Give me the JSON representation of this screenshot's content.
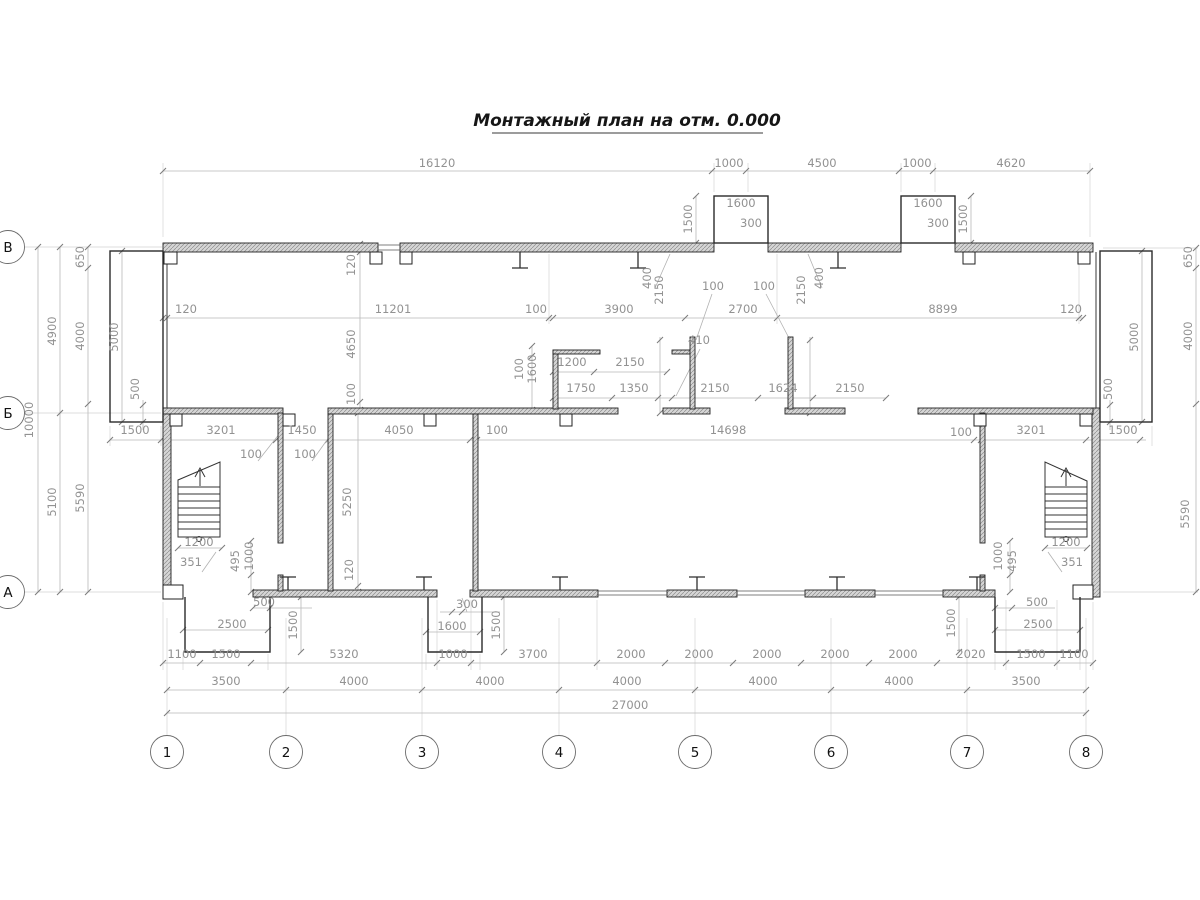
{
  "title": {
    "text": "Монтажный план на отм. 0.000"
  },
  "plan": {
    "colors": {
      "wall_hatch": "#d6d6d6",
      "wall_edge": "#222222",
      "dim_line": "#b9b9b9",
      "dim_text": "#929292",
      "axis_text": "#111111"
    },
    "axis_columns": {
      "y": 752,
      "items": [
        {
          "label": "1",
          "x": 167
        },
        {
          "label": "2",
          "x": 286
        },
        {
          "label": "3",
          "x": 422
        },
        {
          "label": "4",
          "x": 559
        },
        {
          "label": "5",
          "x": 695
        },
        {
          "label": "6",
          "x": 831
        },
        {
          "label": "7",
          "x": 967
        },
        {
          "label": "8",
          "x": 1086
        }
      ]
    },
    "axis_rows": {
      "x": 8,
      "items": [
        {
          "label": "В",
          "y": 247
        },
        {
          "label": "Б",
          "y": 413
        },
        {
          "label": "А",
          "y": 592
        }
      ]
    },
    "dimensions": [
      {
        "t": "16120",
        "x": 437,
        "y": 167,
        "r": 0
      },
      {
        "t": "1000",
        "x": 729,
        "y": 167,
        "r": 0
      },
      {
        "t": "4500",
        "x": 822,
        "y": 167,
        "r": 0
      },
      {
        "t": "1000",
        "x": 917,
        "y": 167,
        "r": 0
      },
      {
        "t": "4620",
        "x": 1011,
        "y": 167,
        "r": 0
      },
      {
        "t": "1600",
        "x": 741,
        "y": 207,
        "r": 0
      },
      {
        "t": "300",
        "x": 751,
        "y": 227,
        "r": 0
      },
      {
        "t": "1600",
        "x": 928,
        "y": 207,
        "r": 0
      },
      {
        "t": "300",
        "x": 938,
        "y": 227,
        "r": 0
      },
      {
        "t": "1500",
        "x": 692,
        "y": 219,
        "r": 1
      },
      {
        "t": "1500",
        "x": 967,
        "y": 219,
        "r": 1
      },
      {
        "t": "400",
        "x": 651,
        "y": 278,
        "r": 1
      },
      {
        "t": "400",
        "x": 823,
        "y": 278,
        "r": 1
      },
      {
        "t": "2150",
        "x": 663,
        "y": 290,
        "r": 1
      },
      {
        "t": "2150",
        "x": 805,
        "y": 290,
        "r": 1
      },
      {
        "t": "100",
        "x": 713,
        "y": 290,
        "r": 0
      },
      {
        "t": "100",
        "x": 764,
        "y": 290,
        "r": 0
      },
      {
        "t": "120",
        "x": 186,
        "y": 313,
        "r": 0
      },
      {
        "t": "11201",
        "x": 393,
        "y": 313,
        "r": 0
      },
      {
        "t": "100",
        "x": 536,
        "y": 313,
        "r": 0
      },
      {
        "t": "3900",
        "x": 619,
        "y": 313,
        "r": 0
      },
      {
        "t": "2700",
        "x": 743,
        "y": 313,
        "r": 0
      },
      {
        "t": "8899",
        "x": 943,
        "y": 313,
        "r": 0
      },
      {
        "t": "120",
        "x": 1071,
        "y": 313,
        "r": 0
      },
      {
        "t": "120",
        "x": 355,
        "y": 265,
        "r": 1
      },
      {
        "t": "4650",
        "x": 355,
        "y": 344,
        "r": 1
      },
      {
        "t": "100",
        "x": 355,
        "y": 394,
        "r": 1
      },
      {
        "t": "100",
        "x": 523,
        "y": 369,
        "r": 1
      },
      {
        "t": "1600",
        "x": 536,
        "y": 369,
        "r": 1
      },
      {
        "t": "1200",
        "x": 572,
        "y": 366,
        "r": 0
      },
      {
        "t": "2150",
        "x": 630,
        "y": 366,
        "r": 0
      },
      {
        "t": "410",
        "x": 699,
        "y": 344,
        "r": 0
      },
      {
        "t": "1750",
        "x": 581,
        "y": 392,
        "r": 0
      },
      {
        "t": "1350",
        "x": 634,
        "y": 392,
        "r": 0
      },
      {
        "t": "2150",
        "x": 715,
        "y": 392,
        "r": 0
      },
      {
        "t": "1624",
        "x": 783,
        "y": 392,
        "r": 0
      },
      {
        "t": "2150",
        "x": 850,
        "y": 392,
        "r": 0
      },
      {
        "t": "10000",
        "x": 33,
        "y": 420,
        "r": 1
      },
      {
        "t": "4900",
        "x": 56,
        "y": 331,
        "r": 1
      },
      {
        "t": "5100",
        "x": 56,
        "y": 502,
        "r": 1
      },
      {
        "t": "650",
        "x": 84,
        "y": 257,
        "r": 1
      },
      {
        "t": "4000",
        "x": 84,
        "y": 336,
        "r": 1
      },
      {
        "t": "5590",
        "x": 84,
        "y": 498,
        "r": 1
      },
      {
        "t": "5000",
        "x": 118,
        "y": 337,
        "r": 1
      },
      {
        "t": "500",
        "x": 139,
        "y": 389,
        "r": 1
      },
      {
        "t": "650",
        "x": 1192,
        "y": 257,
        "r": 1
      },
      {
        "t": "4000",
        "x": 1192,
        "y": 336,
        "r": 1
      },
      {
        "t": "5590",
        "x": 1189,
        "y": 514,
        "r": 1
      },
      {
        "t": "5000",
        "x": 1138,
        "y": 337,
        "r": 1
      },
      {
        "t": "500",
        "x": 1112,
        "y": 389,
        "r": 1
      },
      {
        "t": "1500",
        "x": 135,
        "y": 434,
        "r": 0
      },
      {
        "t": "3201",
        "x": 221,
        "y": 434,
        "r": 0
      },
      {
        "t": "1450",
        "x": 302,
        "y": 434,
        "r": 0
      },
      {
        "t": "4050",
        "x": 399,
        "y": 434,
        "r": 0
      },
      {
        "t": "100",
        "x": 497,
        "y": 434,
        "r": 0
      },
      {
        "t": "14698",
        "x": 728,
        "y": 434,
        "r": 0
      },
      {
        "t": "100",
        "x": 961,
        "y": 436,
        "r": 0
      },
      {
        "t": "3201",
        "x": 1031,
        "y": 434,
        "r": 0
      },
      {
        "t": "1500",
        "x": 1123,
        "y": 434,
        "r": 0
      },
      {
        "t": "100",
        "x": 251,
        "y": 458,
        "r": 0
      },
      {
        "t": "100",
        "x": 305,
        "y": 458,
        "r": 0
      },
      {
        "t": "5250",
        "x": 351,
        "y": 502,
        "r": 1
      },
      {
        "t": "120",
        "x": 353,
        "y": 570,
        "r": 1
      },
      {
        "t": "1200",
        "x": 199,
        "y": 546,
        "r": 0
      },
      {
        "t": "351",
        "x": 191,
        "y": 566,
        "r": 0
      },
      {
        "t": "1200",
        "x": 1066,
        "y": 546,
        "r": 0
      },
      {
        "t": "351",
        "x": 1072,
        "y": 566,
        "r": 0
      },
      {
        "t": "495",
        "x": 239,
        "y": 561,
        "r": 1
      },
      {
        "t": "1000",
        "x": 253,
        "y": 556,
        "r": 1
      },
      {
        "t": "1000",
        "x": 1002,
        "y": 556,
        "r": 1
      },
      {
        "t": "495",
        "x": 1016,
        "y": 561,
        "r": 1
      },
      {
        "t": "500",
        "x": 264,
        "y": 606,
        "r": 0
      },
      {
        "t": "2500",
        "x": 232,
        "y": 628,
        "r": 0
      },
      {
        "t": "300",
        "x": 467,
        "y": 608,
        "r": 0
      },
      {
        "t": "1600",
        "x": 452,
        "y": 630,
        "r": 0
      },
      {
        "t": "500",
        "x": 1037,
        "y": 606,
        "r": 0
      },
      {
        "t": "2500",
        "x": 1038,
        "y": 628,
        "r": 0
      },
      {
        "t": "1500",
        "x": 297,
        "y": 625,
        "r": 1
      },
      {
        "t": "1500",
        "x": 500,
        "y": 625,
        "r": 1
      },
      {
        "t": "1500",
        "x": 955,
        "y": 623,
        "r": 1
      },
      {
        "t": "1100",
        "x": 182,
        "y": 658,
        "r": 0
      },
      {
        "t": "1500",
        "x": 226,
        "y": 658,
        "r": 0
      },
      {
        "t": "5320",
        "x": 344,
        "y": 658,
        "r": 0
      },
      {
        "t": "1000",
        "x": 453,
        "y": 658,
        "r": 0
      },
      {
        "t": "3700",
        "x": 533,
        "y": 658,
        "r": 0
      },
      {
        "t": "2000",
        "x": 631,
        "y": 658,
        "r": 0
      },
      {
        "t": "2000",
        "x": 699,
        "y": 658,
        "r": 0
      },
      {
        "t": "2000",
        "x": 767,
        "y": 658,
        "r": 0
      },
      {
        "t": "2000",
        "x": 835,
        "y": 658,
        "r": 0
      },
      {
        "t": "2000",
        "x": 903,
        "y": 658,
        "r": 0
      },
      {
        "t": "2020",
        "x": 971,
        "y": 658,
        "r": 0
      },
      {
        "t": "1500",
        "x": 1031,
        "y": 658,
        "r": 0
      },
      {
        "t": "1100",
        "x": 1074,
        "y": 658,
        "r": 0
      },
      {
        "t": "3500",
        "x": 226,
        "y": 685,
        "r": 0
      },
      {
        "t": "4000",
        "x": 354,
        "y": 685,
        "r": 0
      },
      {
        "t": "4000",
        "x": 490,
        "y": 685,
        "r": 0
      },
      {
        "t": "4000",
        "x": 627,
        "y": 685,
        "r": 0
      },
      {
        "t": "4000",
        "x": 763,
        "y": 685,
        "r": 0
      },
      {
        "t": "4000",
        "x": 899,
        "y": 685,
        "r": 0
      },
      {
        "t": "3500",
        "x": 1026,
        "y": 685,
        "r": 0
      },
      {
        "t": "27000",
        "x": 630,
        "y": 709,
        "r": 0
      }
    ]
  }
}
